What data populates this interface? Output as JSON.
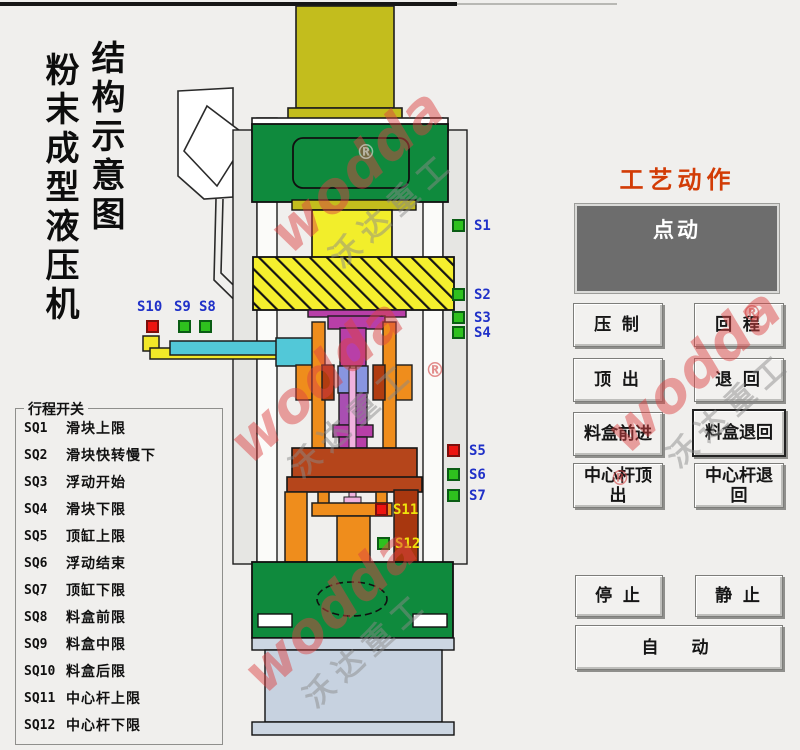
{
  "page": {
    "vertical_title_left": "粉末成型液压机",
    "vertical_title_right": "结构示意图"
  },
  "legend": {
    "title": "行程开关",
    "items": [
      {
        "code": "SQ1",
        "label": "滑块上限"
      },
      {
        "code": "SQ2",
        "label": "滑块快转慢下"
      },
      {
        "code": "SQ3",
        "label": "浮动开始"
      },
      {
        "code": "SQ4",
        "label": "滑块下限"
      },
      {
        "code": "SQ5",
        "label": "顶缸上限"
      },
      {
        "code": "SQ6",
        "label": "浮动结束"
      },
      {
        "code": "SQ7",
        "label": "顶缸下限"
      },
      {
        "code": "SQ8",
        "label": "料盒前限"
      },
      {
        "code": "SQ9",
        "label": "料盒中限"
      },
      {
        "code": "SQ10",
        "label": "料盒后限"
      },
      {
        "code": "SQ11",
        "label": "中心杆上限"
      },
      {
        "code": "SQ12",
        "label": "中心杆下限"
      }
    ]
  },
  "sensors": [
    {
      "id": "S1",
      "state": "green"
    },
    {
      "id": "S2",
      "state": "green"
    },
    {
      "id": "S3",
      "state": "green"
    },
    {
      "id": "S4",
      "state": "green"
    },
    {
      "id": "S5",
      "state": "red"
    },
    {
      "id": "S6",
      "state": "green"
    },
    {
      "id": "S7",
      "state": "green"
    },
    {
      "id": "S8",
      "state": "green"
    },
    {
      "id": "S9",
      "state": "green"
    },
    {
      "id": "S10",
      "state": "red"
    },
    {
      "id": "S11",
      "state": "red"
    },
    {
      "id": "S12",
      "state": "green"
    }
  ],
  "panel": {
    "title": "工艺动作",
    "mode_display": "点动",
    "buttons": {
      "press": "压 制",
      "return": "回 程",
      "eject": "顶 出",
      "retreat": "退 回",
      "box_forward": "料盒前进",
      "box_back": "料盒退回",
      "rod_eject": "中心杆顶出",
      "rod_back": "中心杆退回",
      "stop": "停 止",
      "still": "静 止",
      "auto": "自　动"
    }
  },
  "watermark": {
    "latin": "wodda",
    "chinese": "沃达重工",
    "reg": "®"
  },
  "colors": {
    "title_accent": "#d23c06",
    "sensor_on": "#2ec01e",
    "sensor_alert": "#ec1410",
    "sensor_label_blue": "#2031c8",
    "sensor_label_yellow": "#efe40c",
    "machine_green": "#0f8a3d",
    "machine_yellow": "#f2ee2b",
    "machine_olive": "#c3bd1d",
    "machine_orange": "#ef8d1c",
    "machine_brick": "#b5451b",
    "machine_magenta": "#b83fa8",
    "machine_cyan": "#52c8d8",
    "machine_base_gray": "#c7d2e0"
  }
}
